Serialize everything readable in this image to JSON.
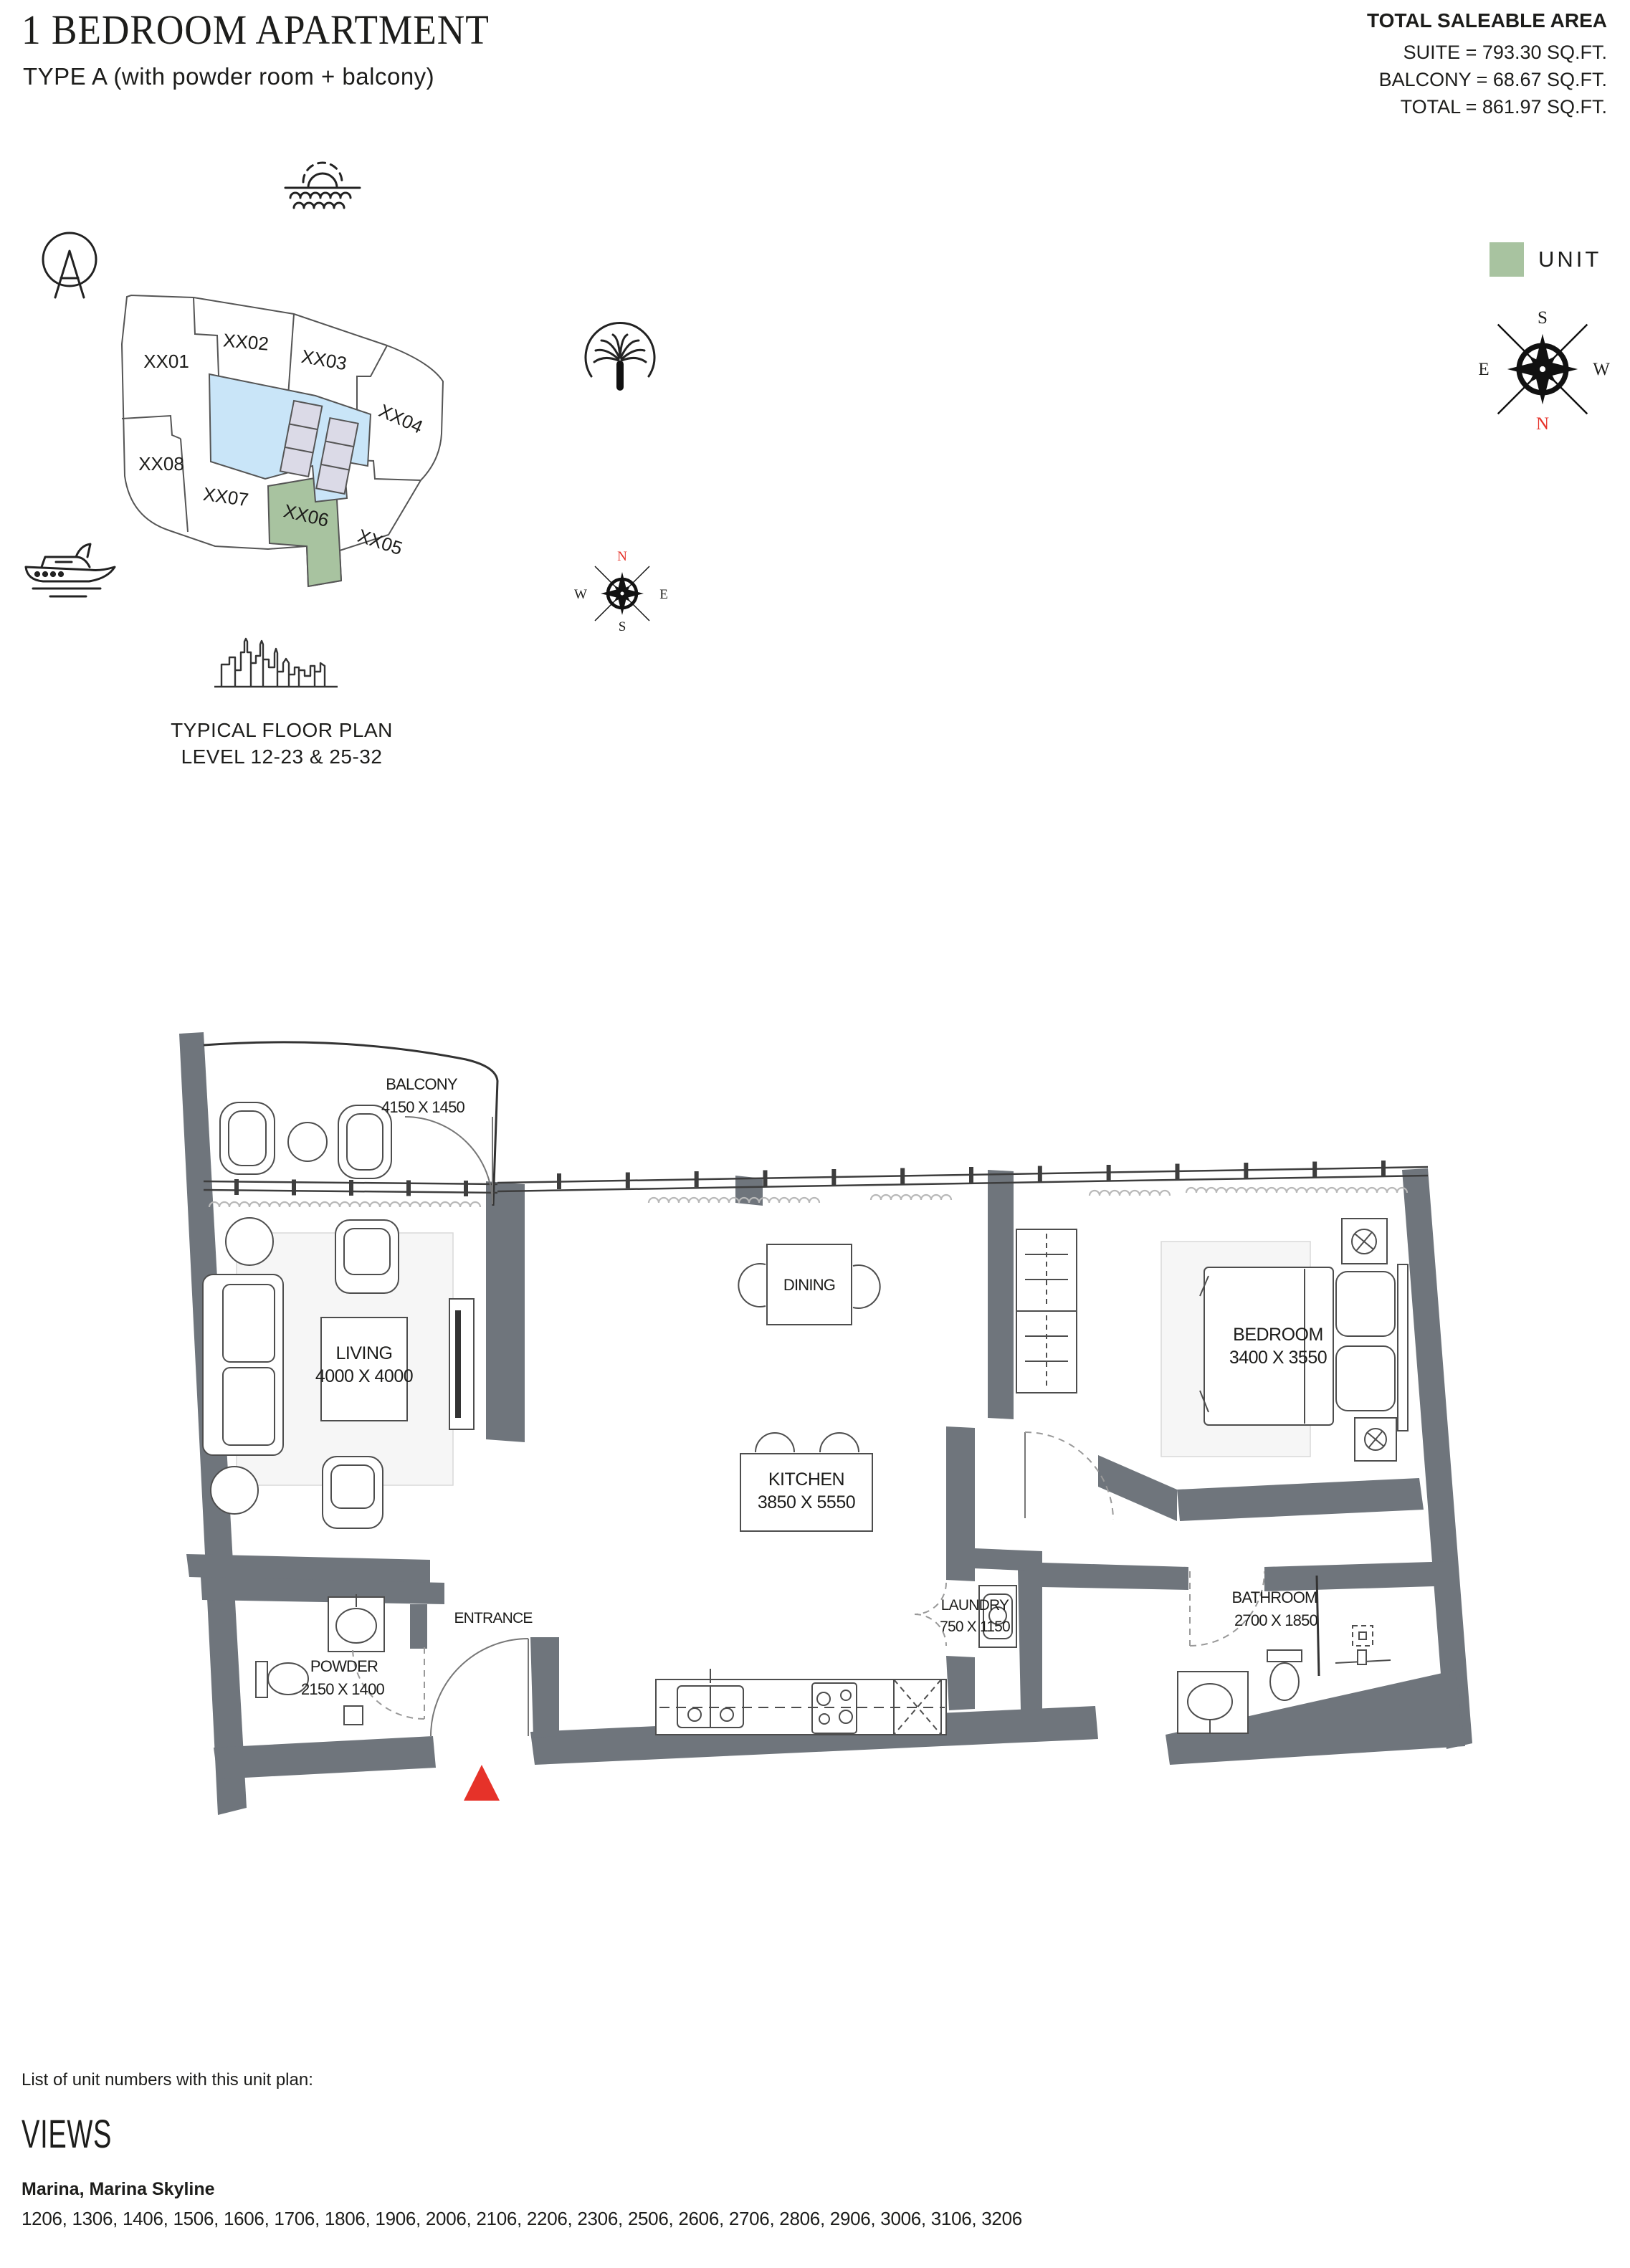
{
  "header": {
    "title": "1 BEDROOM APARTMENT",
    "subtitle": "TYPE A (with powder room + balcony)",
    "area": {
      "heading": "TOTAL SALEABLE AREA",
      "suite": "SUITE = 793.30 SQ.FT.",
      "balcony": "BALCONY = 68.67 SQ.FT.",
      "total": "TOTAL = 861.97 SQ.FT."
    }
  },
  "keyplan": {
    "units": [
      {
        "label": "XX01"
      },
      {
        "label": "XX02"
      },
      {
        "label": "XX03"
      },
      {
        "label": "XX04"
      },
      {
        "label": "XX05"
      },
      {
        "label": "XX06",
        "highlighted": true
      },
      {
        "label": "XX07"
      },
      {
        "label": "XX08"
      }
    ],
    "legend_label": "UNIT",
    "caption_line1": "TYPICAL FLOOR PLAN",
    "caption_line2": "LEVEL 12-23 & 25-32",
    "compass_main": {
      "top": "S",
      "left": "E",
      "right": "W",
      "bottom": "N"
    },
    "compass_small": {
      "top": "N",
      "left": "W",
      "right": "E",
      "bottom": "S"
    }
  },
  "floorplan": {
    "rooms": [
      {
        "name": "BALCONY",
        "dims": "4150 X 1450"
      },
      {
        "name": "LIVING",
        "dims": "4000 X 4000"
      },
      {
        "name": "DINING",
        "dims": ""
      },
      {
        "name": "KITCHEN",
        "dims": "3850 X 5550"
      },
      {
        "name": "BEDROOM",
        "dims": "3400 X 3550"
      },
      {
        "name": "POWDER",
        "dims": "2150 X 1400"
      },
      {
        "name": "ENTRANCE",
        "dims": ""
      },
      {
        "name": "LAUNDRY",
        "dims": "750 X 1150"
      },
      {
        "name": "BATHROOM",
        "dims": "2700 X 1850"
      }
    ]
  },
  "footer": {
    "note": "List of unit numbers with this unit plan:",
    "views_heading": "VIEWS",
    "views": "Marina, Marina Skyline",
    "unit_numbers": "1206, 1306, 1406, 1506, 1606, 1706, 1806, 1906, 2006, 2106, 2206, 2306, 2506, 2606, 2706, 2806, 2906, 3006, 3106, 3206"
  },
  "colors": {
    "unit_highlight_green": "#A8C3A0",
    "core_blue": "#C9E5F8",
    "elevator_lavender": "#DBDAE7",
    "wall_gray": "#6F757C",
    "marker_red": "#E63229"
  }
}
